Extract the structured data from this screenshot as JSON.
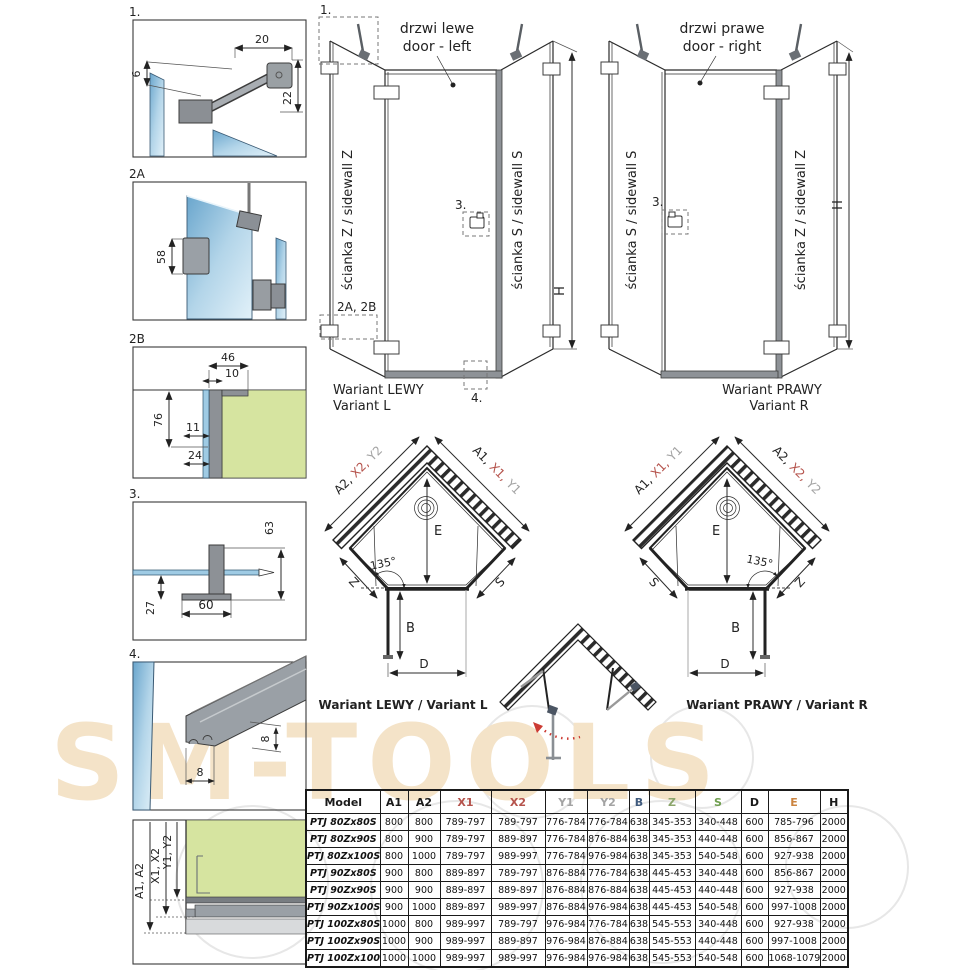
{
  "watermark": {
    "text": "SM-TOOLS"
  },
  "details": {
    "d1": {
      "label": "1.",
      "dim_top": "20",
      "dim_left": "6",
      "dim_right": "22"
    },
    "d2a": {
      "label": "2A",
      "dim_left": "58"
    },
    "d2b": {
      "label": "2B",
      "dim_top": "46",
      "dim_inner": "10",
      "dim_left": "76",
      "dim_mid": "11",
      "dim_bottom": "24"
    },
    "d3": {
      "label": "3.",
      "dim_right": "63",
      "dim_left": "27",
      "dim_bottom": "60"
    },
    "d4": {
      "label": "4.",
      "dim_right": "8",
      "dim_bottom": "8"
    },
    "d5": {
      "label_a": "A1, A2",
      "label_x": "X1, X2",
      "label_y": "Y1, Y2"
    }
  },
  "elevation_left": {
    "callout_1": "1.",
    "door_line1": "drzwi lewe",
    "door_line2": "door - left",
    "wall_left": "ścianka Z / sidewall Z",
    "wall_right": "ścianka S / sidewall S",
    "callout_2": "2A, 2B",
    "callout_3": "3.",
    "callout_4": "4.",
    "height": "H",
    "caption_line1": "Wariant LEWY",
    "caption_line2": "Variant L"
  },
  "elevation_right": {
    "door_line1": "drzwi prawe",
    "door_line2": "door - right",
    "wall_left": "ścianka S / sidewall S",
    "wall_right": "ścianka Z / sidewall Z",
    "callout_3": "3.",
    "height": "H",
    "caption_line1": "Wariant PRAWY",
    "caption_line2": "Variant R"
  },
  "topview_left": {
    "ul_a": "A2,",
    "ul_x": "X2,",
    "ul_y": "Y2",
    "ur_a": "A1,",
    "ur_x": "X1,",
    "ur_y": "Y1",
    "dim_e": "E",
    "angle": "135°",
    "dim_wall_left": "Z",
    "dim_wall_right": "S",
    "dim_b": "B",
    "dim_d": "D",
    "caption": "Wariant LEWY / Variant L"
  },
  "topview_right": {
    "ul_a": "A1,",
    "ul_x": "X1,",
    "ul_y": "Y1",
    "ur_a": "A2,",
    "ur_x": "X2,",
    "ur_y": "Y2",
    "dim_e": "E",
    "angle": "135°",
    "dim_wall_left": "S",
    "dim_wall_right": "Z",
    "dim_b": "B",
    "dim_d": "D",
    "caption": "Wariant PRAWY / Variant R"
  },
  "table": {
    "headers": [
      {
        "label": "Model",
        "color": "#1a1a1a"
      },
      {
        "label": "A1",
        "color": "#1a1a1a"
      },
      {
        "label": "A2",
        "color": "#1a1a1a"
      },
      {
        "label": "X1",
        "color": "#b5534c"
      },
      {
        "label": "X2",
        "color": "#b5534c"
      },
      {
        "label": "Y1",
        "color": "#a3a3a3"
      },
      {
        "label": "Y2",
        "color": "#a3a3a3"
      },
      {
        "label": "B",
        "color": "#3f5a7d"
      },
      {
        "label": "Z",
        "color": "#8ba56b"
      },
      {
        "label": "S",
        "color": "#6f9e4f"
      },
      {
        "label": "D",
        "color": "#1a1a1a"
      },
      {
        "label": "E",
        "color": "#cb8440"
      },
      {
        "label": "H",
        "color": "#1a1a1a"
      }
    ],
    "rows": [
      [
        "PTJ 80Zx80S",
        "800",
        "800",
        "789-797",
        "789-797",
        "776-784",
        "776-784",
        "638",
        "345-353",
        "340-448",
        "600",
        "785-796",
        "2000"
      ],
      [
        "PTJ 80Zx90S",
        "800",
        "900",
        "789-797",
        "889-897",
        "776-784",
        "876-884",
        "638",
        "345-353",
        "440-448",
        "600",
        "856-867",
        "2000"
      ],
      [
        "PTJ 80Zx100S",
        "800",
        "1000",
        "789-797",
        "989-997",
        "776-784",
        "976-984",
        "638",
        "345-353",
        "540-548",
        "600",
        "927-938",
        "2000"
      ],
      [
        "PTJ 90Zx80S",
        "900",
        "800",
        "889-897",
        "789-797",
        "876-884",
        "776-784",
        "638",
        "445-453",
        "340-448",
        "600",
        "856-867",
        "2000"
      ],
      [
        "PTJ 90Zx90S",
        "900",
        "900",
        "889-897",
        "889-897",
        "876-884",
        "876-884",
        "638",
        "445-453",
        "440-448",
        "600",
        "927-938",
        "2000"
      ],
      [
        "PTJ 90Zx100S",
        "900",
        "1000",
        "889-897",
        "989-997",
        "876-884",
        "976-984",
        "638",
        "445-453",
        "540-548",
        "600",
        "997-1008",
        "2000"
      ],
      [
        "PTJ 100Zx80S",
        "1000",
        "800",
        "989-997",
        "789-797",
        "976-984",
        "776-784",
        "638",
        "545-553",
        "340-448",
        "600",
        "927-938",
        "2000"
      ],
      [
        "PTJ 100Zx90S",
        "1000",
        "900",
        "989-997",
        "889-897",
        "976-984",
        "876-884",
        "638",
        "545-553",
        "440-448",
        "600",
        "997-1008",
        "2000"
      ],
      [
        "PTJ 100Zx100S",
        "1000",
        "1000",
        "989-997",
        "989-997",
        "976-984",
        "976-984",
        "638",
        "545-553",
        "540-548",
        "600",
        "1068-1079",
        "2000"
      ]
    ]
  },
  "colors": {
    "x_red": "#b5534c",
    "y_gray": "#a3a3a3",
    "b_blue": "#4e6fa8",
    "zs_green": "#79a351",
    "e_orange": "#cb8440",
    "glass_blue": "#9fcbe4",
    "wall_green": "#d6e4a0",
    "watermark": "#f4e3c8"
  }
}
